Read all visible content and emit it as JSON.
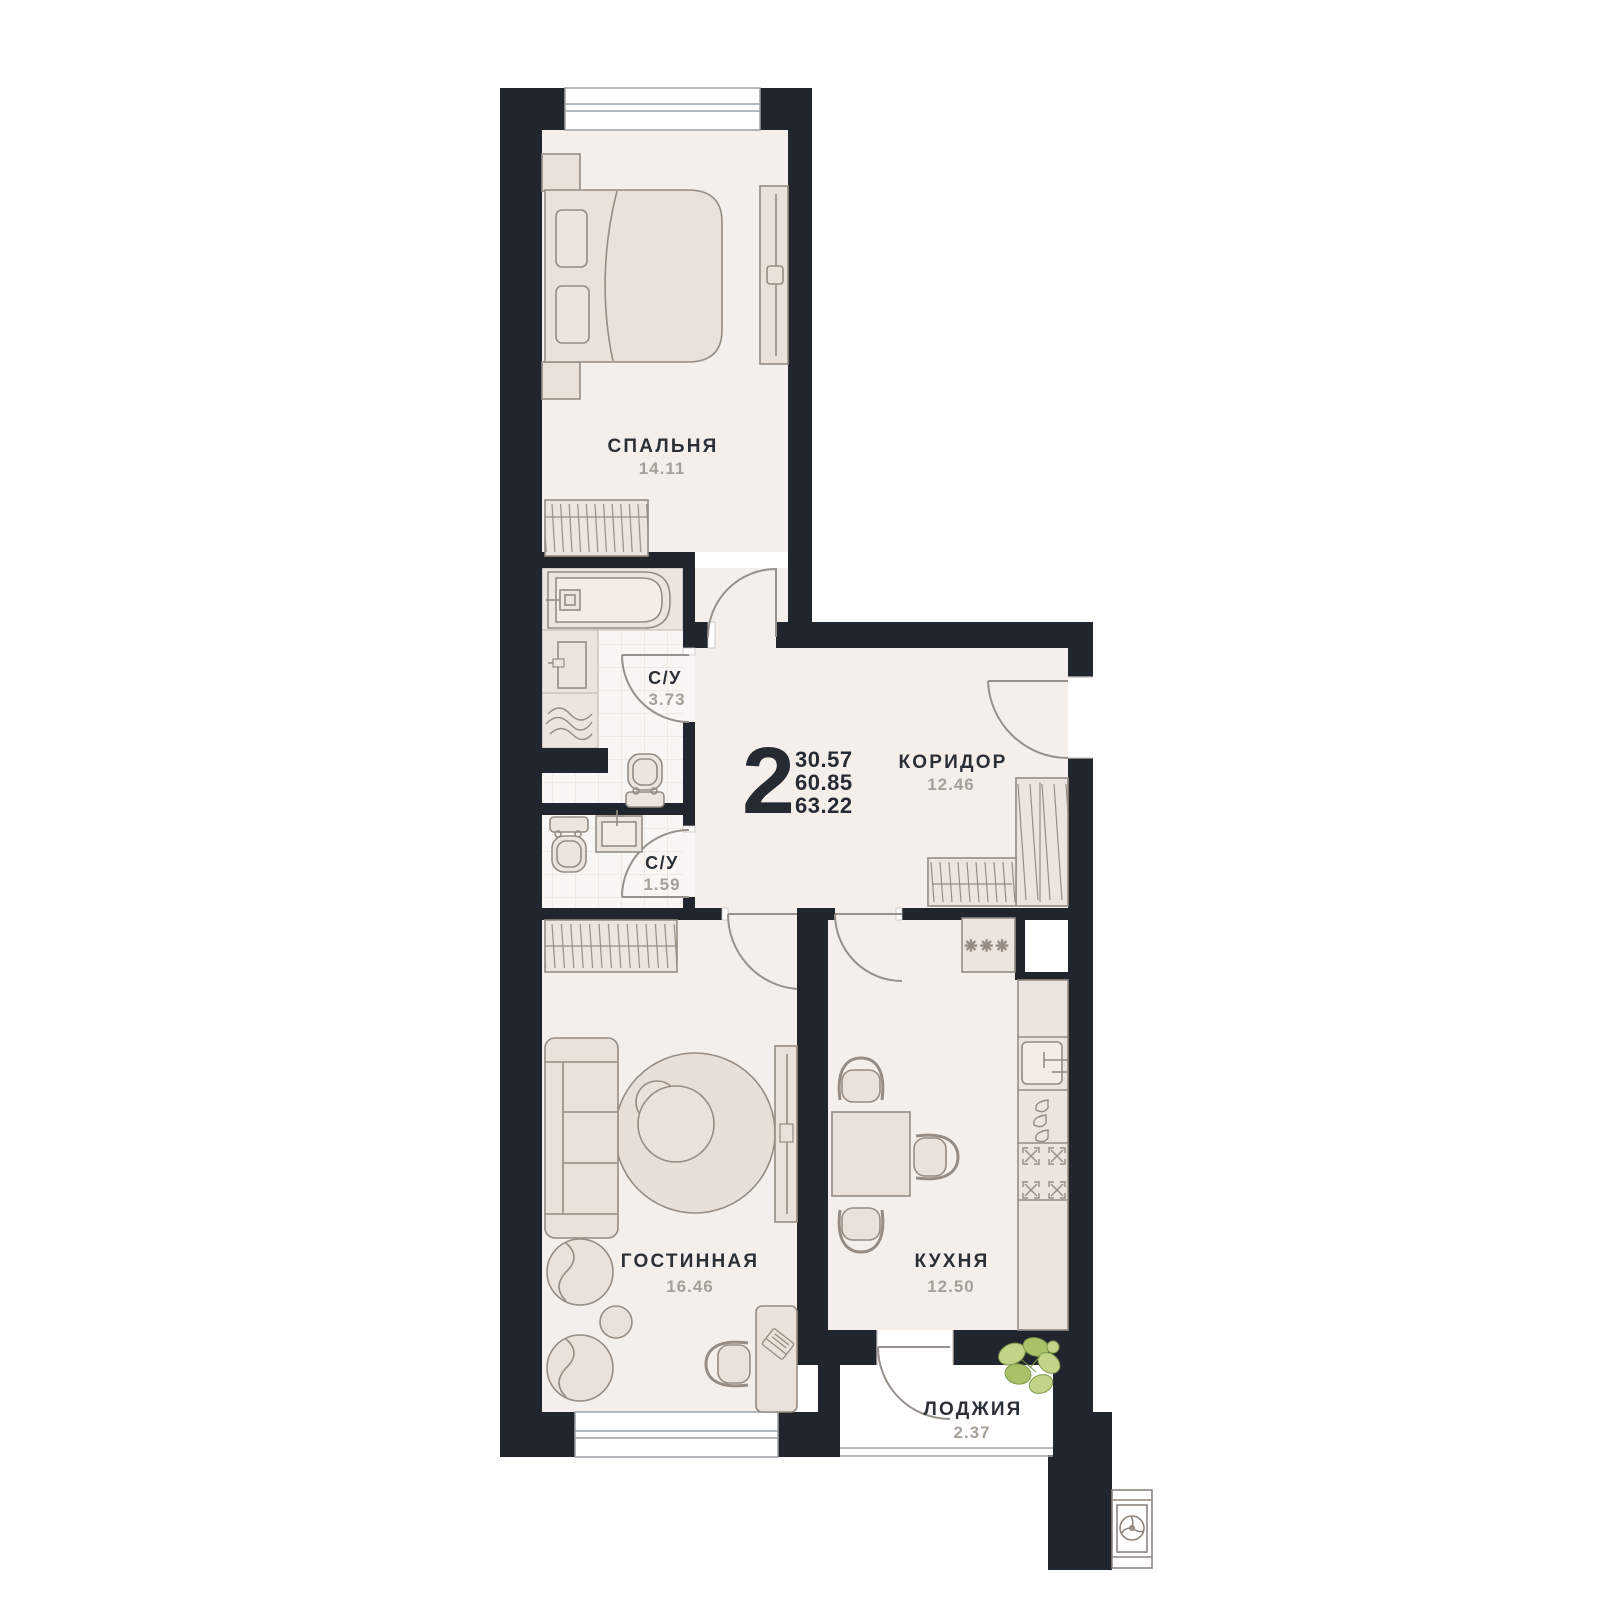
{
  "plan": {
    "rooms_count": "2",
    "areas": {
      "living": "30.57",
      "total": "60.85",
      "full": "63.22"
    }
  },
  "rooms": {
    "bedroom": {
      "label": "СПАЛЬНЯ",
      "area": "14.11"
    },
    "bathroom": {
      "label": "С/У",
      "area": "3.73"
    },
    "toilet": {
      "label": "С/У",
      "area": "1.59"
    },
    "corridor": {
      "label": "КОРИДОР",
      "area": "12.46"
    },
    "living": {
      "label": "ГОСТИННАЯ",
      "area": "16.46"
    },
    "kitchen": {
      "label": "КУХНЯ",
      "area": "12.50"
    },
    "loggia": {
      "label": "ЛОДЖИЯ",
      "area": "2.37"
    }
  },
  "symbols": {
    "fridge_stars": "✳✳✳"
  },
  "colors": {
    "wall": "#21262e",
    "floor": "#f5efeb",
    "tile_floor": "#faf6f3",
    "beige_patch": "#ece4de",
    "furniture_fill": "#e9e1da",
    "furniture_stroke": "#968c83",
    "window_stroke": "#9aa0a5",
    "label_dark": "#2b3037",
    "area_gray": "#a7a098",
    "plant_green": "#b9cf83"
  }
}
